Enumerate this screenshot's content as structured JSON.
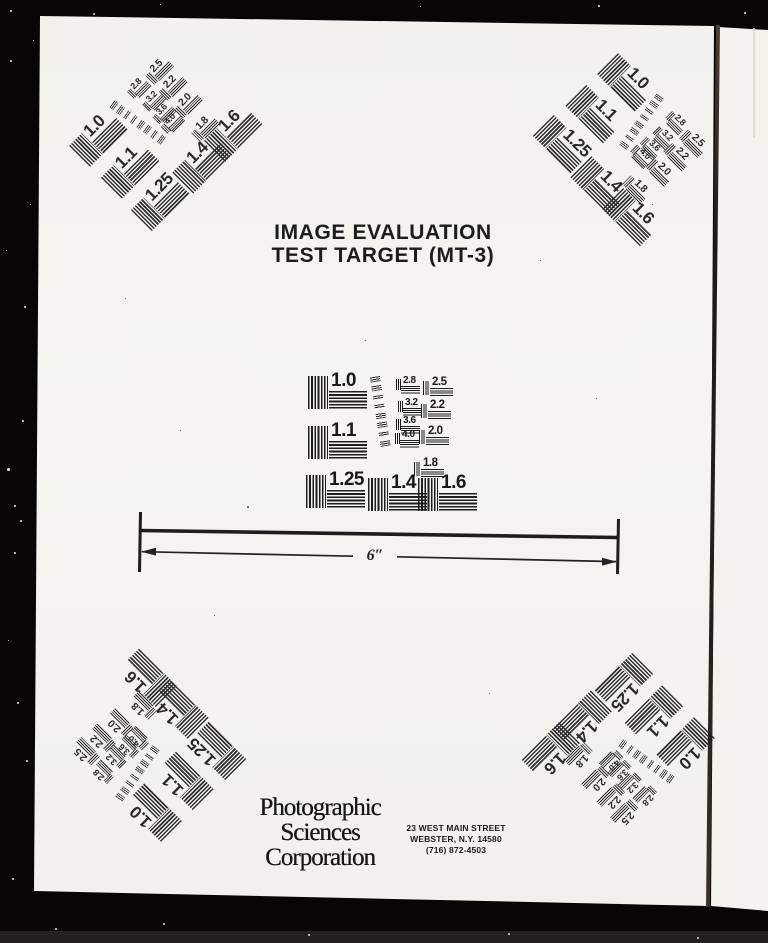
{
  "header": {
    "title_line1": "IMAGE EVALUATION",
    "title_line2": "TEST TARGET (MT-3)"
  },
  "scale": {
    "label": "6″"
  },
  "footer": {
    "publisher_line1": "Photographic",
    "publisher_line2": "Sciences",
    "publisher_line3": "Corporation",
    "address_line1": "23 WEST MAIN STREET",
    "address_line2": "WEBSTER, N.Y. 14580",
    "address_line3": "(716) 872-4503"
  },
  "test_pattern": {
    "large_values": [
      "1.0",
      "1.1",
      "1.25",
      "1.4",
      "1.6"
    ],
    "medium_values": [
      "2.5",
      "2.2",
      "2.0",
      "1.8"
    ],
    "small_values": [
      "2.8",
      "3.2",
      "3.6",
      "4.0"
    ],
    "micro_row_count": 8,
    "instances": [
      "top-left",
      "top-right",
      "center",
      "bottom-left",
      "bottom-right"
    ]
  },
  "colors": {
    "film_black": "#070605",
    "page_white": "#f4f3ee",
    "ink": "#1c1c1c"
  }
}
